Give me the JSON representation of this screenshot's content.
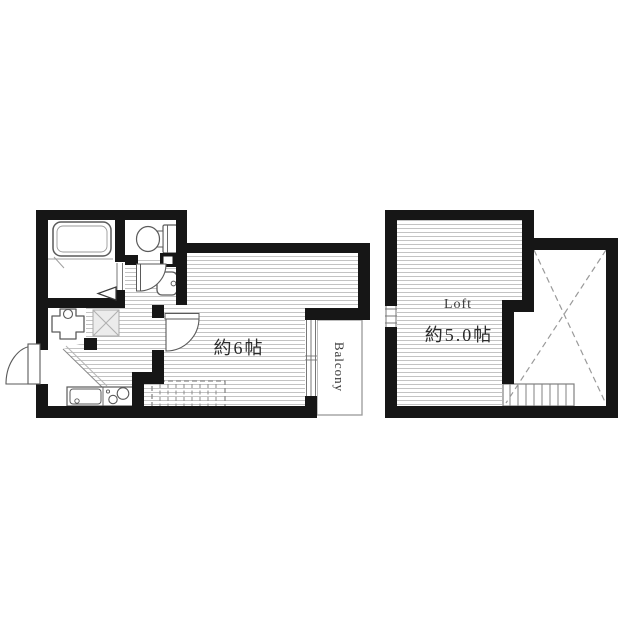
{
  "first_floor": {
    "room_area_label": "約6帖",
    "balcony_label": "Balcony",
    "fixtures": [
      "bathtub",
      "toilet",
      "wash-basin",
      "bath-folding-door",
      "washing-machine-pan",
      "appliance-space-x",
      "kitchen-sink",
      "stove-2-burner",
      "entrance-door",
      "room-door",
      "loft-ladder-dashed",
      "balcony-window"
    ]
  },
  "loft_floor": {
    "name_label": "Loft",
    "area_label": "約5.0帖",
    "features": [
      "left-wall-window",
      "void-cross-dashed",
      "loft-stairs"
    ]
  },
  "colors": {
    "wall": "#161616",
    "hatch_line": "#c3c3c3",
    "fixture_stroke": "#5a5a5a",
    "dash_gray": "#9a9a9a",
    "background": "#ffffff"
  }
}
